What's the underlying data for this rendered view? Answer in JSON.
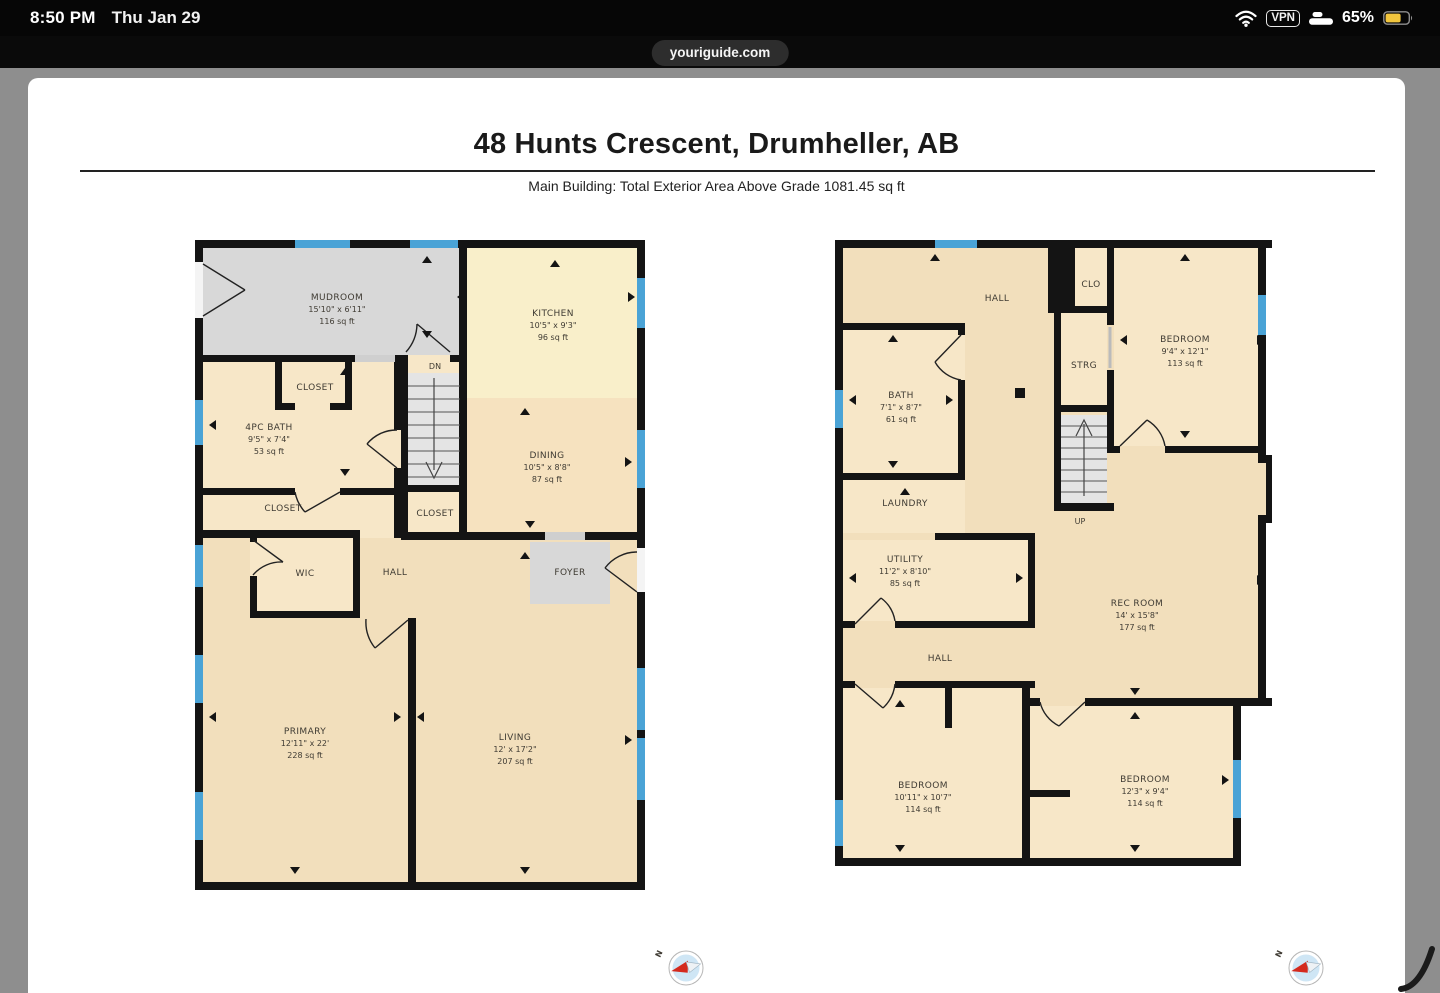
{
  "status_bar": {
    "time": "8:50 PM",
    "date": "Thu Jan 29",
    "vpn_label": "VPN",
    "battery_percent": "65%"
  },
  "browser": {
    "url": "youriguide.com"
  },
  "page": {
    "title": "48 Hunts Crescent, Drumheller, AB",
    "subtitle": "Main Building: Total Exterior Area Above Grade 1081.45 sq ft"
  },
  "main_floor": {
    "stair_label": "DN",
    "mudroom": {
      "name": "MUDROOM",
      "dims": "15'10\" x 6'11\"",
      "area": "116 sq ft"
    },
    "kitchen": {
      "name": "KITCHEN",
      "dims": "10'5\" x 9'3\"",
      "area": "96 sq ft"
    },
    "dining": {
      "name": "DINING",
      "dims": "10'5\" x 8'8\"",
      "area": "87 sq ft"
    },
    "bath": {
      "name": "4PC BATH",
      "dims": "9'5\" x 7'4\"",
      "area": "53 sq ft"
    },
    "closet_top": {
      "name": "CLOSET"
    },
    "closet_mid": {
      "name": "CLOSET"
    },
    "closet_stairs": {
      "name": "CLOSET"
    },
    "wic": {
      "name": "WIC"
    },
    "hall": {
      "name": "HALL"
    },
    "foyer": {
      "name": "FOYER"
    },
    "primary": {
      "name": "PRIMARY",
      "dims": "12'11\" x 22'",
      "area": "228 sq ft"
    },
    "living": {
      "name": "LIVING",
      "dims": "12' x 17'2\"",
      "area": "207 sq ft"
    }
  },
  "basement": {
    "stair_label": "UP",
    "hall_upper": {
      "name": "HALL"
    },
    "clo": {
      "name": "CLO"
    },
    "bedroom_ne": {
      "name": "BEDROOM",
      "dims": "9'4\" x 12'1\"",
      "area": "113 sq ft"
    },
    "bath": {
      "name": "BATH",
      "dims": "7'1\" x 8'7\"",
      "area": "61 sq ft"
    },
    "strg": {
      "name": "STRG"
    },
    "laundry": {
      "name": "LAUNDRY"
    },
    "utility": {
      "name": "UTILITY",
      "dims": "11'2\" x 8'10\"",
      "area": "85 sq ft"
    },
    "rec_room": {
      "name": "REC ROOM",
      "dims": "14' x 15'8\"",
      "area": "177 sq ft"
    },
    "hall_lower": {
      "name": "HALL"
    },
    "bedroom_sw": {
      "name": "BEDROOM",
      "dims": "10'11\" x 10'7\"",
      "area": "114 sq ft"
    },
    "bedroom_se": {
      "name": "BEDROOM",
      "dims": "12'3\" x 9'4\"",
      "area": "114 sq ft"
    }
  },
  "compass": {
    "north_label": "N"
  },
  "colors": {
    "wall": "#141414",
    "window_blue": "#4aa3d6",
    "room_tan": "#f2dfbc",
    "room_peach": "#f7e7c8",
    "kitchen_cream": "#f9efca",
    "dining_peach": "#f6e2bf",
    "floor_gray": "#d8d8d8",
    "stairs_gray": "#e4e4e4",
    "battery_yellow": "#f2c63e",
    "margin_gray": "#8e8e8e"
  }
}
